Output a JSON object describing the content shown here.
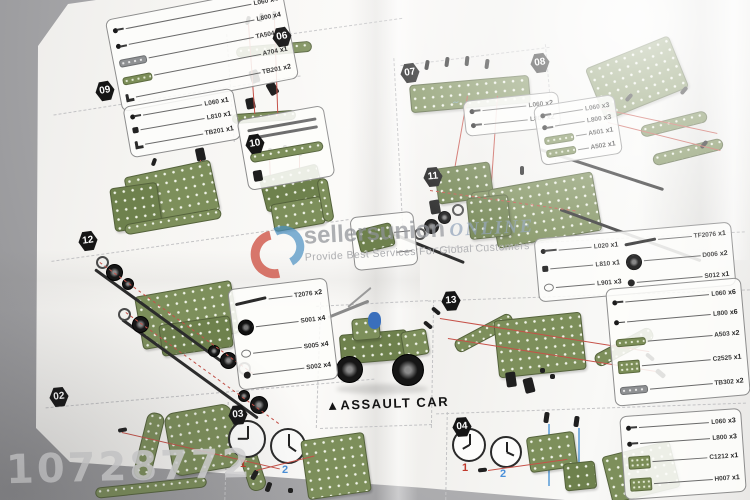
{
  "title": {
    "marker": "▲",
    "label": "ASSAULT CAR"
  },
  "badges": [
    {
      "id": "06"
    },
    {
      "id": "07"
    },
    {
      "id": "08"
    },
    {
      "id": "09"
    },
    {
      "id": "10"
    },
    {
      "id": "11"
    },
    {
      "id": "12"
    },
    {
      "id": "13"
    },
    {
      "id": "02"
    },
    {
      "id": "03"
    },
    {
      "id": "04"
    }
  ],
  "clocks": {
    "one": "1",
    "two": "2"
  },
  "watermark": {
    "brand": "sellersunion",
    "suffix": "ONLINE",
    "tagline": "Provide Best Services For Global Customers",
    "number": "10728772",
    "logo_red": "#cd4b3c",
    "logo_blue": "#4a90c2"
  },
  "colors": {
    "plate_green": "#7d8f5b",
    "guide_red": "#c65148",
    "guide_blue": "#7fb2de"
  },
  "parts_boxes": {
    "top_left": {
      "rows": [
        {
          "icon": "screw",
          "code": "L060",
          "qty": "x4"
        },
        {
          "icon": "screw",
          "code": "L800",
          "qty": "x4"
        },
        {
          "icon": "strip-gray",
          "code": "TA504",
          "qty": "x1"
        },
        {
          "icon": "strip-green",
          "code": "A704",
          "qty": "x1"
        },
        {
          "icon": "bracket",
          "code": "TB201",
          "qty": "x2"
        }
      ]
    },
    "step09": {
      "rows": [
        {
          "icon": "screw",
          "code": "L060",
          "qty": "x1"
        },
        {
          "icon": "nut",
          "code": "L810",
          "qty": "x1"
        },
        {
          "icon": "bracket",
          "code": "TB201",
          "qty": "x1"
        }
      ]
    },
    "step07": {
      "rows": [
        {
          "icon": "screw",
          "code": "L060",
          "qty": "x2"
        },
        {
          "icon": "screw",
          "code": "L800",
          "qty": "x2"
        }
      ]
    },
    "step08": {
      "rows": [
        {
          "icon": "screw",
          "code": "L060",
          "qty": "x3"
        },
        {
          "icon": "screw",
          "code": "L800",
          "qty": "x3"
        },
        {
          "icon": "strip-green",
          "code": "A501",
          "qty": "x1"
        },
        {
          "icon": "strip-green",
          "code": "A502",
          "qty": "x1"
        }
      ]
    },
    "mid_right_left": {
      "rows": [
        {
          "icon": "screw-long",
          "code": "L020",
          "qty": "x1"
        },
        {
          "icon": "nut",
          "code": "L810",
          "qty": "x1"
        },
        {
          "icon": "ring",
          "code": "L901",
          "qty": "x3"
        }
      ]
    },
    "mid_right_right": {
      "rows": [
        {
          "icon": "rod",
          "code": "TF2076",
          "qty": "x1"
        },
        {
          "icon": "wheel",
          "code": "D006",
          "qty": "x2"
        },
        {
          "icon": "hub",
          "code": "S012",
          "qty": "x1"
        }
      ]
    },
    "step12": {
      "rows": [
        {
          "icon": "rod",
          "code": "T2076",
          "qty": "x2"
        },
        {
          "icon": "wheel",
          "code": "S001",
          "qty": "x4"
        },
        {
          "icon": "ring",
          "code": "S005",
          "qty": "x4"
        },
        {
          "icon": "hub",
          "code": "S002",
          "qty": "x4"
        }
      ]
    },
    "right": {
      "rows": [
        {
          "icon": "screw",
          "code": "L060",
          "qty": "x6"
        },
        {
          "icon": "screw",
          "code": "L800",
          "qty": "x6"
        },
        {
          "icon": "strip-green",
          "code": "A503",
          "qty": "x2"
        },
        {
          "icon": "plate-green",
          "code": "C2525",
          "qty": "x1"
        },
        {
          "icon": "strip-gray",
          "code": "TB302",
          "qty": "x2"
        }
      ]
    },
    "bottom_right": {
      "rows": [
        {
          "icon": "screw",
          "code": "L060",
          "qty": "x3"
        },
        {
          "icon": "screw",
          "code": "L800",
          "qty": "x3"
        },
        {
          "icon": "plate-green",
          "code": "C1212",
          "qty": "x1"
        },
        {
          "icon": "plate-green",
          "code": "H007",
          "qty": "x1"
        }
      ]
    }
  }
}
